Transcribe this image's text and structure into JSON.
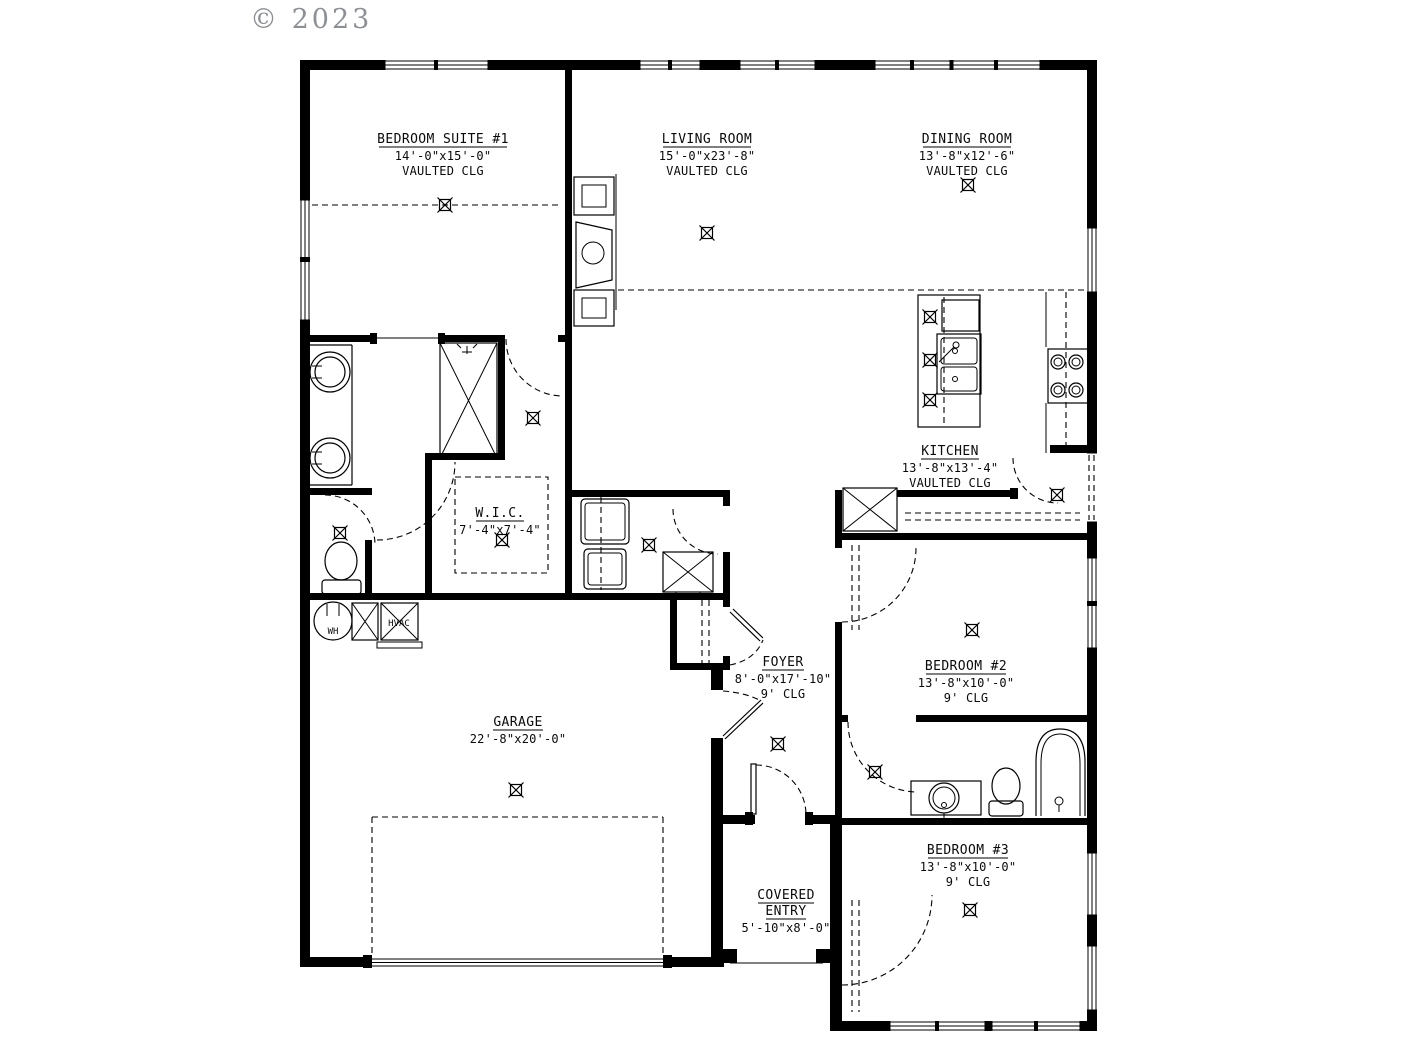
{
  "watermark": "© 2023",
  "plan": {
    "rooms": {
      "bedroom_suite_1": {
        "name": "BEDROOM SUITE #1",
        "dims": "14'-0\"x15'-0\"",
        "ceiling": "VAULTED CLG"
      },
      "living_room": {
        "name": "LIVING ROOM",
        "dims": "15'-0\"x23'-8\"",
        "ceiling": "VAULTED CLG"
      },
      "dining_room": {
        "name": "DINING ROOM",
        "dims": "13'-8\"x12'-6\"",
        "ceiling": "VAULTED CLG"
      },
      "kitchen": {
        "name": "KITCHEN",
        "dims": "13'-8\"x13'-4\"",
        "ceiling": "VAULTED CLG"
      },
      "wic": {
        "name": "W.I.C.",
        "dims": "7'-4\"x7'-4\""
      },
      "foyer": {
        "name": "FOYER",
        "dims": "8'-0\"x17'-10\"",
        "ceiling": "9' CLG"
      },
      "garage": {
        "name": "GARAGE",
        "dims": "22'-8\"x20'-0\""
      },
      "bedroom_2": {
        "name": "BEDROOM #2",
        "dims": "13'-8\"x10'-0\"",
        "ceiling": "9' CLG"
      },
      "bedroom_3": {
        "name": "BEDROOM #3",
        "dims": "13'-8\"x10'-0\"",
        "ceiling": "9' CLG"
      },
      "covered_entry": {
        "name_line1": "COVERED",
        "name_line2": "ENTRY",
        "dims": "5'-10\"x8'-0\""
      }
    },
    "equipment": {
      "water_heater": "WH",
      "hvac": "HVAC"
    }
  },
  "colors": {
    "line": "#000000",
    "watermark": "#8c9094",
    "background": "#ffffff"
  }
}
